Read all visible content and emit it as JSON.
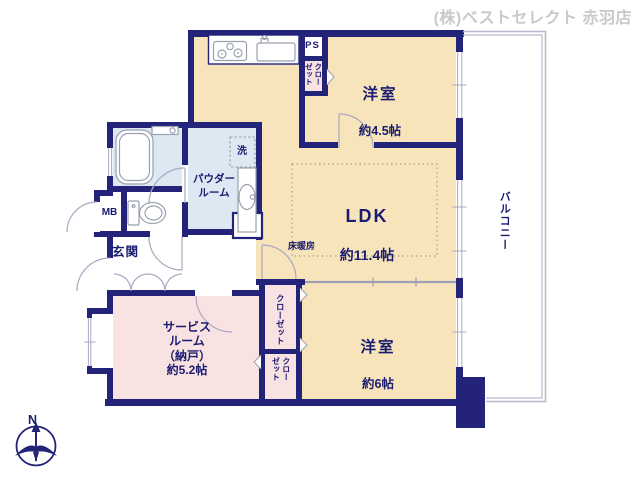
{
  "header": {
    "company": "(株)ベストセレクト 赤羽店"
  },
  "rooms": {
    "western_room_45": {
      "name": "洋室",
      "size": "約4.5帖"
    },
    "ldk": {
      "name": "LDK",
      "size": "約11.4帖"
    },
    "western_room_6": {
      "name": "洋室",
      "size": "約6帖"
    },
    "service_room": {
      "text": "サービス\nルーム\n（納戸）\n約5.2帖"
    },
    "powder_room": {
      "text": "パウダー\nルーム"
    },
    "entrance": "玄関",
    "balcony": "バルコニー",
    "floor_heating": "床暖房"
  },
  "labels": {
    "closet_kitchen_top": "クロー\nゼット",
    "closet_west6": "クローゼット",
    "closet_service": "クロー\nゼット",
    "ps": "PS",
    "mb": "MB",
    "washer": "洗",
    "north": "N"
  },
  "colors": {
    "wall": "#23237a",
    "text": "#1b1b70",
    "cream": "#f7e4bb",
    "pink": "#f9e3e2",
    "bath_blue": "#dde9f2",
    "door_arc": "#a8a8c2",
    "glass": "#a9a9c6",
    "balcony_line": "#b7b7d0",
    "heating_dots": "#ac9f8b",
    "slide": "#9e9eb8",
    "header_gray": "#c9c9c9",
    "fixture": "#9aa0b0"
  }
}
